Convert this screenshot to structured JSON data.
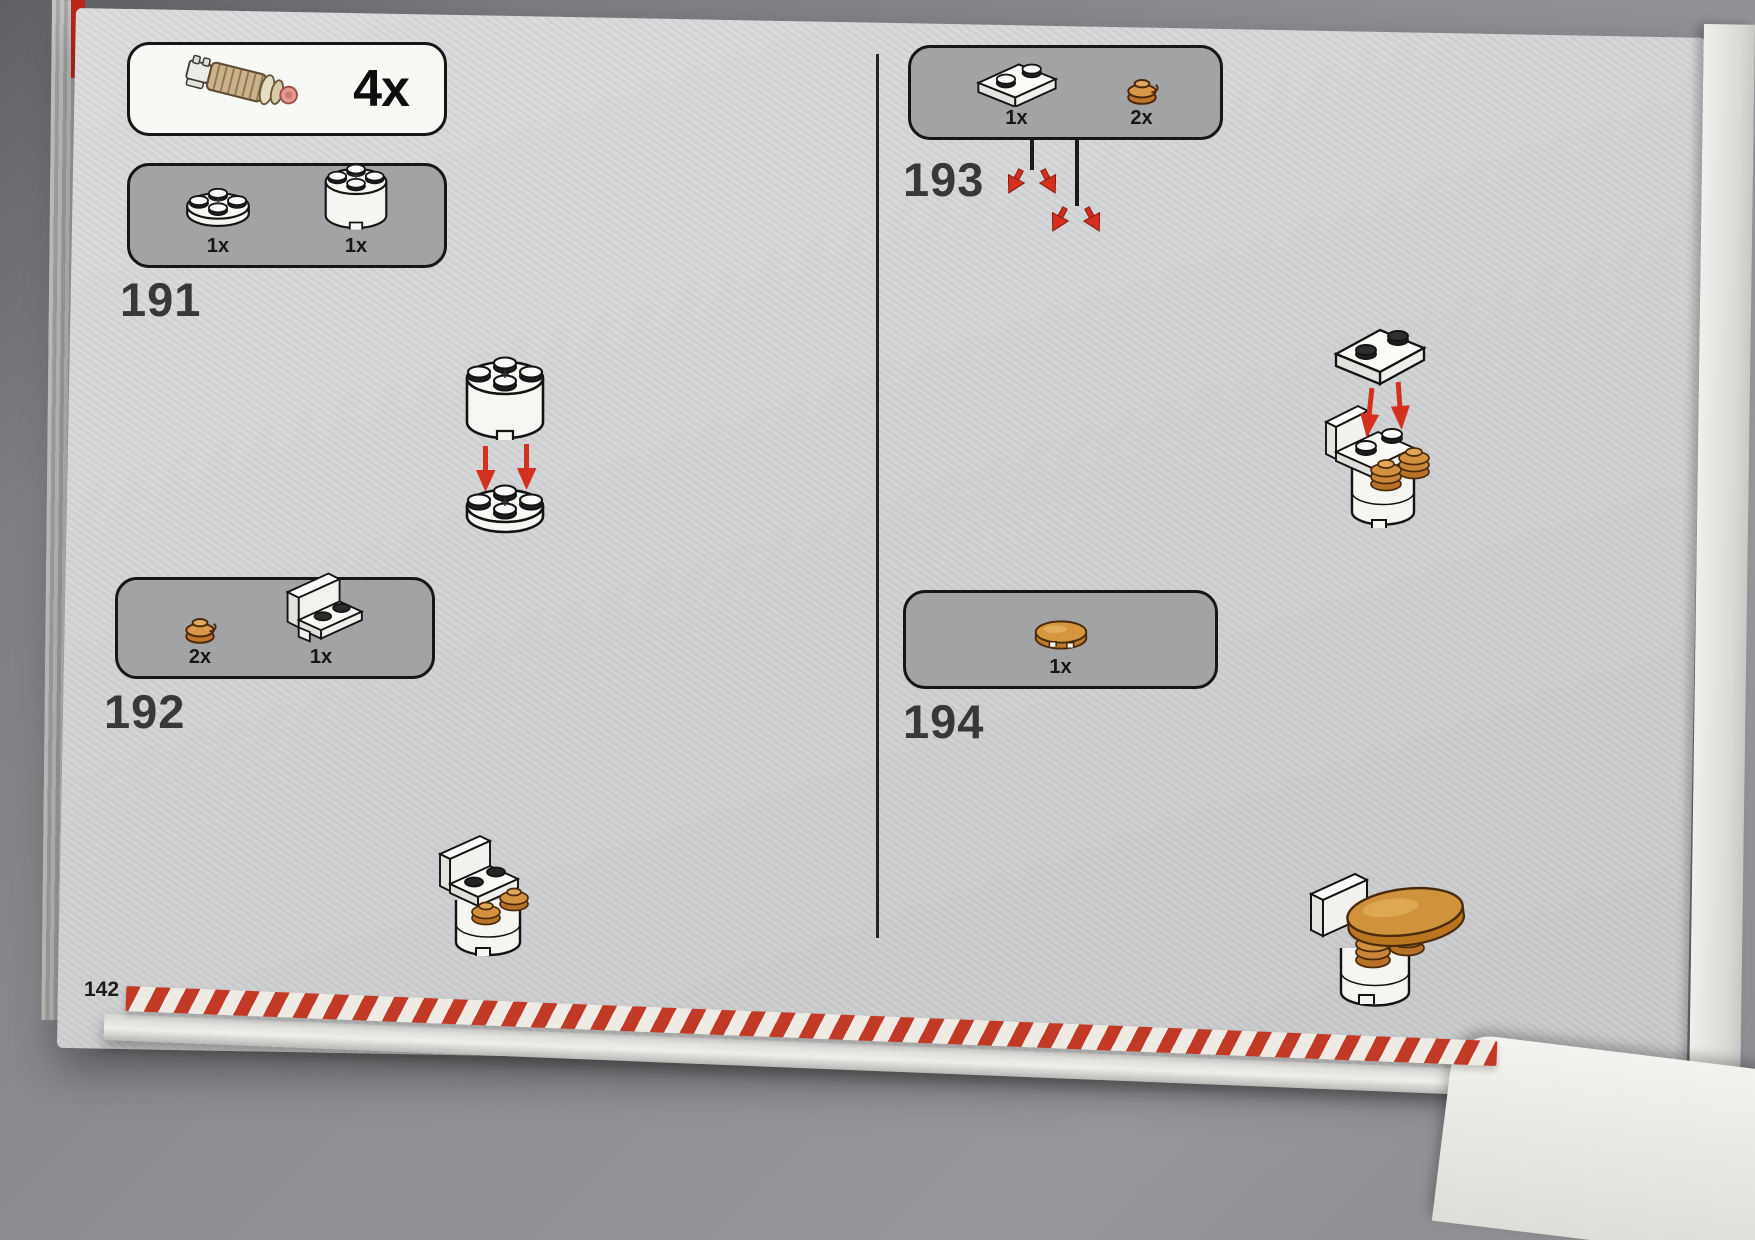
{
  "colors": {
    "arrow_red": "#d4301f",
    "gold": "#cf8f3c",
    "paper": "#d3d4d6",
    "box_gray": "#a2a3a5",
    "stripe_red": "#c23a26"
  },
  "callout": {
    "count": "4x",
    "part": "thruster-engine-piece"
  },
  "steps": {
    "s191": {
      "number": "191",
      "parts": [
        {
          "name": "round-plate-2x2-white",
          "count": "1x"
        },
        {
          "name": "round-brick-2x2-white",
          "count": "1x"
        }
      ]
    },
    "s192": {
      "number": "192",
      "parts": [
        {
          "name": "round-plate-1x1-gold",
          "count": "2x"
        },
        {
          "name": "bracket-panel-1x2-white",
          "count": "1x"
        }
      ]
    },
    "s193": {
      "number": "193",
      "parts": [
        {
          "name": "plate-1x2-white",
          "count": "1x"
        },
        {
          "name": "round-plate-1x1-gold",
          "count": "2x"
        }
      ]
    },
    "s194": {
      "number": "194",
      "parts": [
        {
          "name": "round-tile-2x2-gold",
          "count": "1x"
        }
      ]
    }
  },
  "footer": {
    "page_number": "142"
  }
}
